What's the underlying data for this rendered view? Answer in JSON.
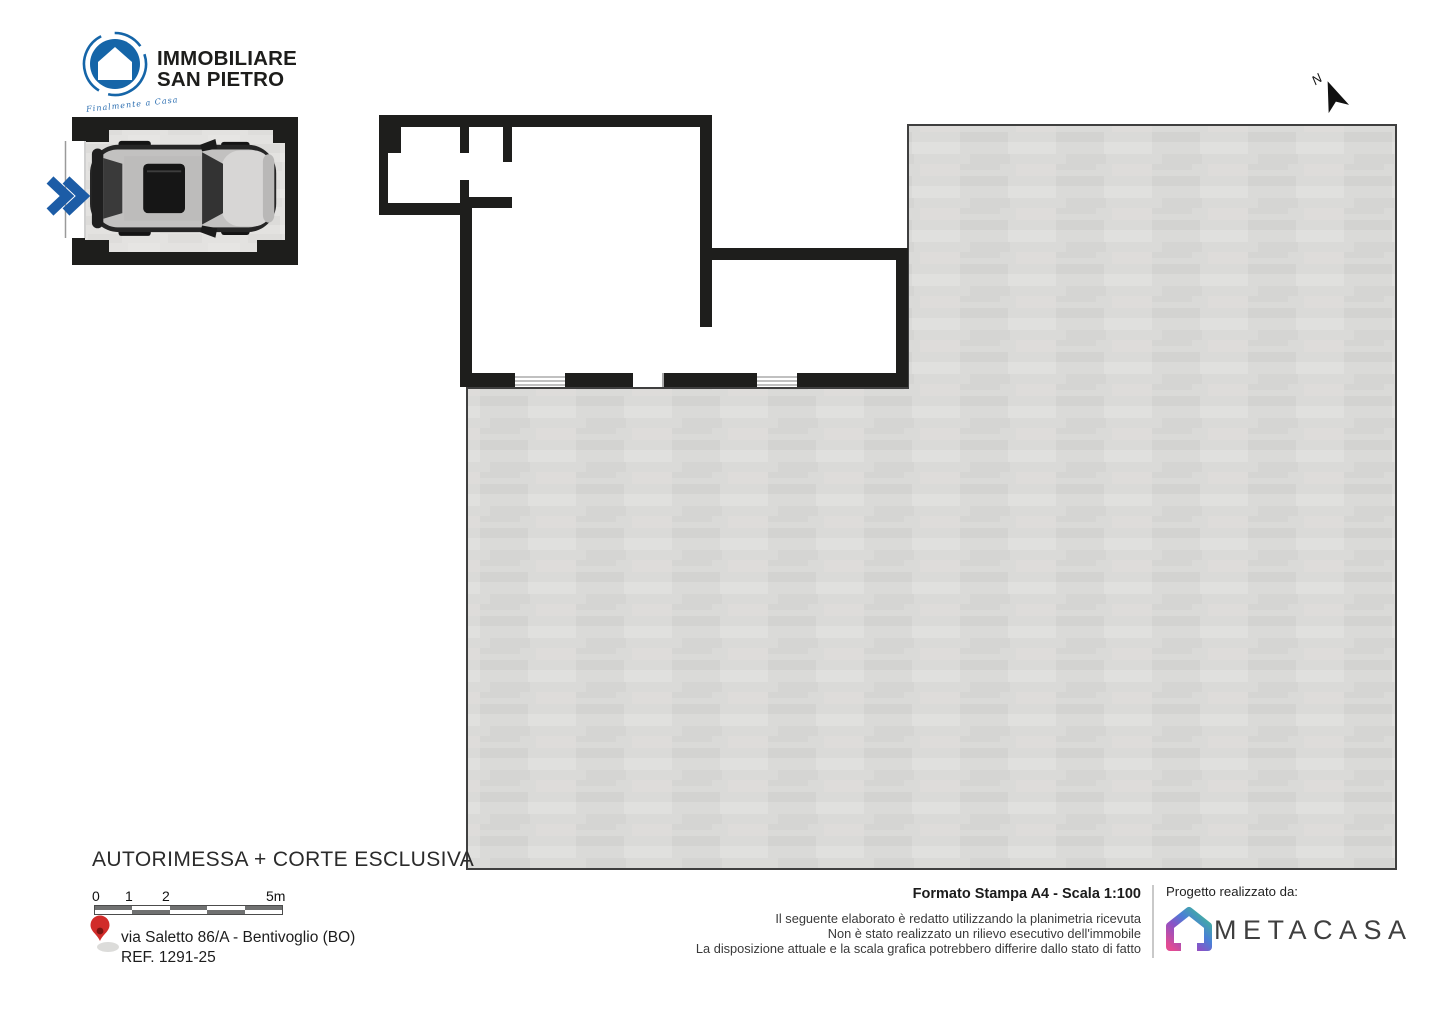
{
  "branding": {
    "agency": {
      "name_line1": "IMMOBILIARE",
      "name_line2": "SAN PIETRO",
      "tagline": "Finalmente a Casa"
    },
    "credit": {
      "label": "Progetto realizzato da:",
      "brand": "METACASA"
    }
  },
  "plan": {
    "title": "AUTORIMESSA + CORTE ESCLUSIVA",
    "north_label": "N",
    "scale_bar": {
      "labels": [
        "0",
        "1",
        "2",
        "5m"
      ]
    },
    "address": {
      "line1": "via Saletto 86/A - Bentivoglio (BO)",
      "line2": "REF. 1291-25"
    }
  },
  "print_info": {
    "format": "Formato Stampa A4 - Scala 1:100",
    "disclaimer": [
      "Il seguente elaborato è redatto utilizzando la planimetria ricevuta",
      "Non è stato realizzato un rilievo esecutivo dell'immobile",
      "La disposizione attuale e la scala grafica potrebbero differire dallo stato di fatto"
    ]
  },
  "colors": {
    "brand_blue": "#1565a8",
    "wall_black": "#1e1e1c",
    "courtyard_gray": "#d9d9d7",
    "pin_red": "#d12c2a",
    "scalebar_dark": "#707171",
    "metacasa_text": "#3f3f3f"
  }
}
